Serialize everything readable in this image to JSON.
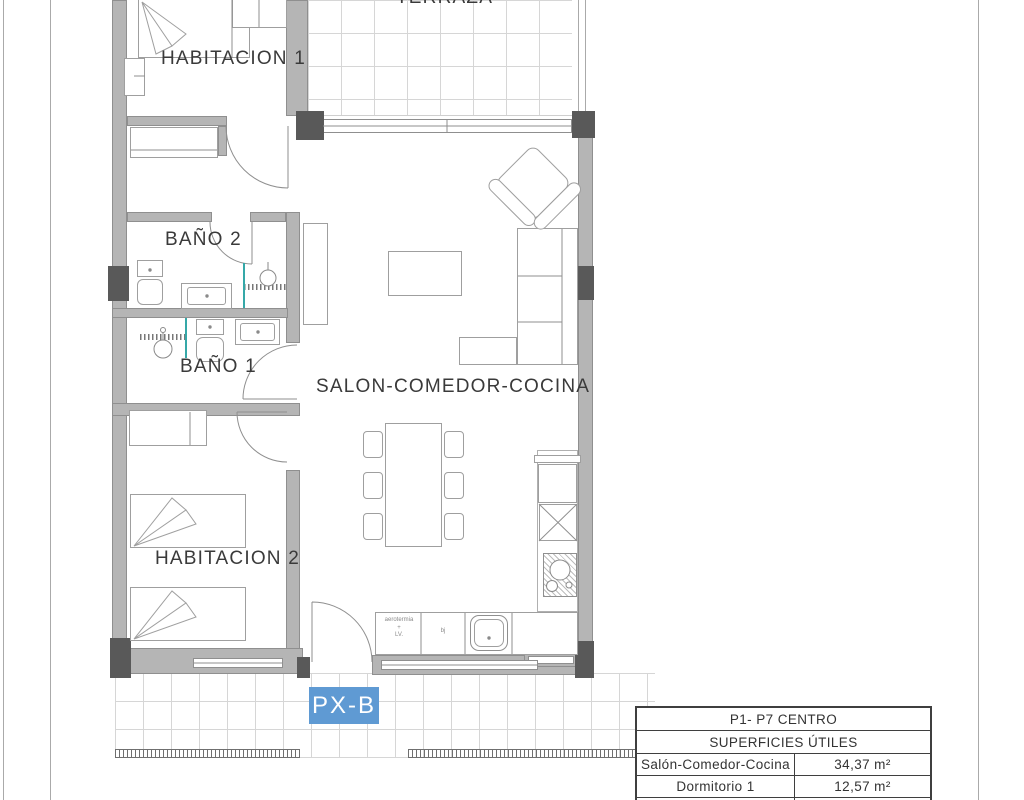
{
  "sheet": {
    "unit_label": "PX-B"
  },
  "rooms": {
    "terraza": "TERRAZA",
    "habitacion1": "HABITACION 1",
    "bano2": "BAÑO 2",
    "bano1": "BAÑO 1",
    "salon": "SALON-COMEDOR-COCINA",
    "habitacion2": "HABITACION 2"
  },
  "kitchen": {
    "boiler_note": [
      "aerotermia",
      "+",
      "LV."
    ],
    "appliance_note": "bj"
  },
  "summary_table": {
    "title": "P1- P7 CENTRO",
    "subtitle": "SUPERFICIES ÚTILES",
    "rows": [
      {
        "label": "Salón-Comedor-Cocina",
        "value": "34,37 m²"
      },
      {
        "label": "Dormitorio 1",
        "value": "12,57 m²"
      },
      {
        "label": "Dormitorio 2",
        "value": "12,14 m²"
      }
    ]
  },
  "colors": {
    "wall": "#b5b5b5",
    "column": "#595959",
    "unit_badge_bg": "#5f9ad3",
    "tile_line": "#d6d6d6",
    "fixture_teal": "#35a8a8"
  }
}
